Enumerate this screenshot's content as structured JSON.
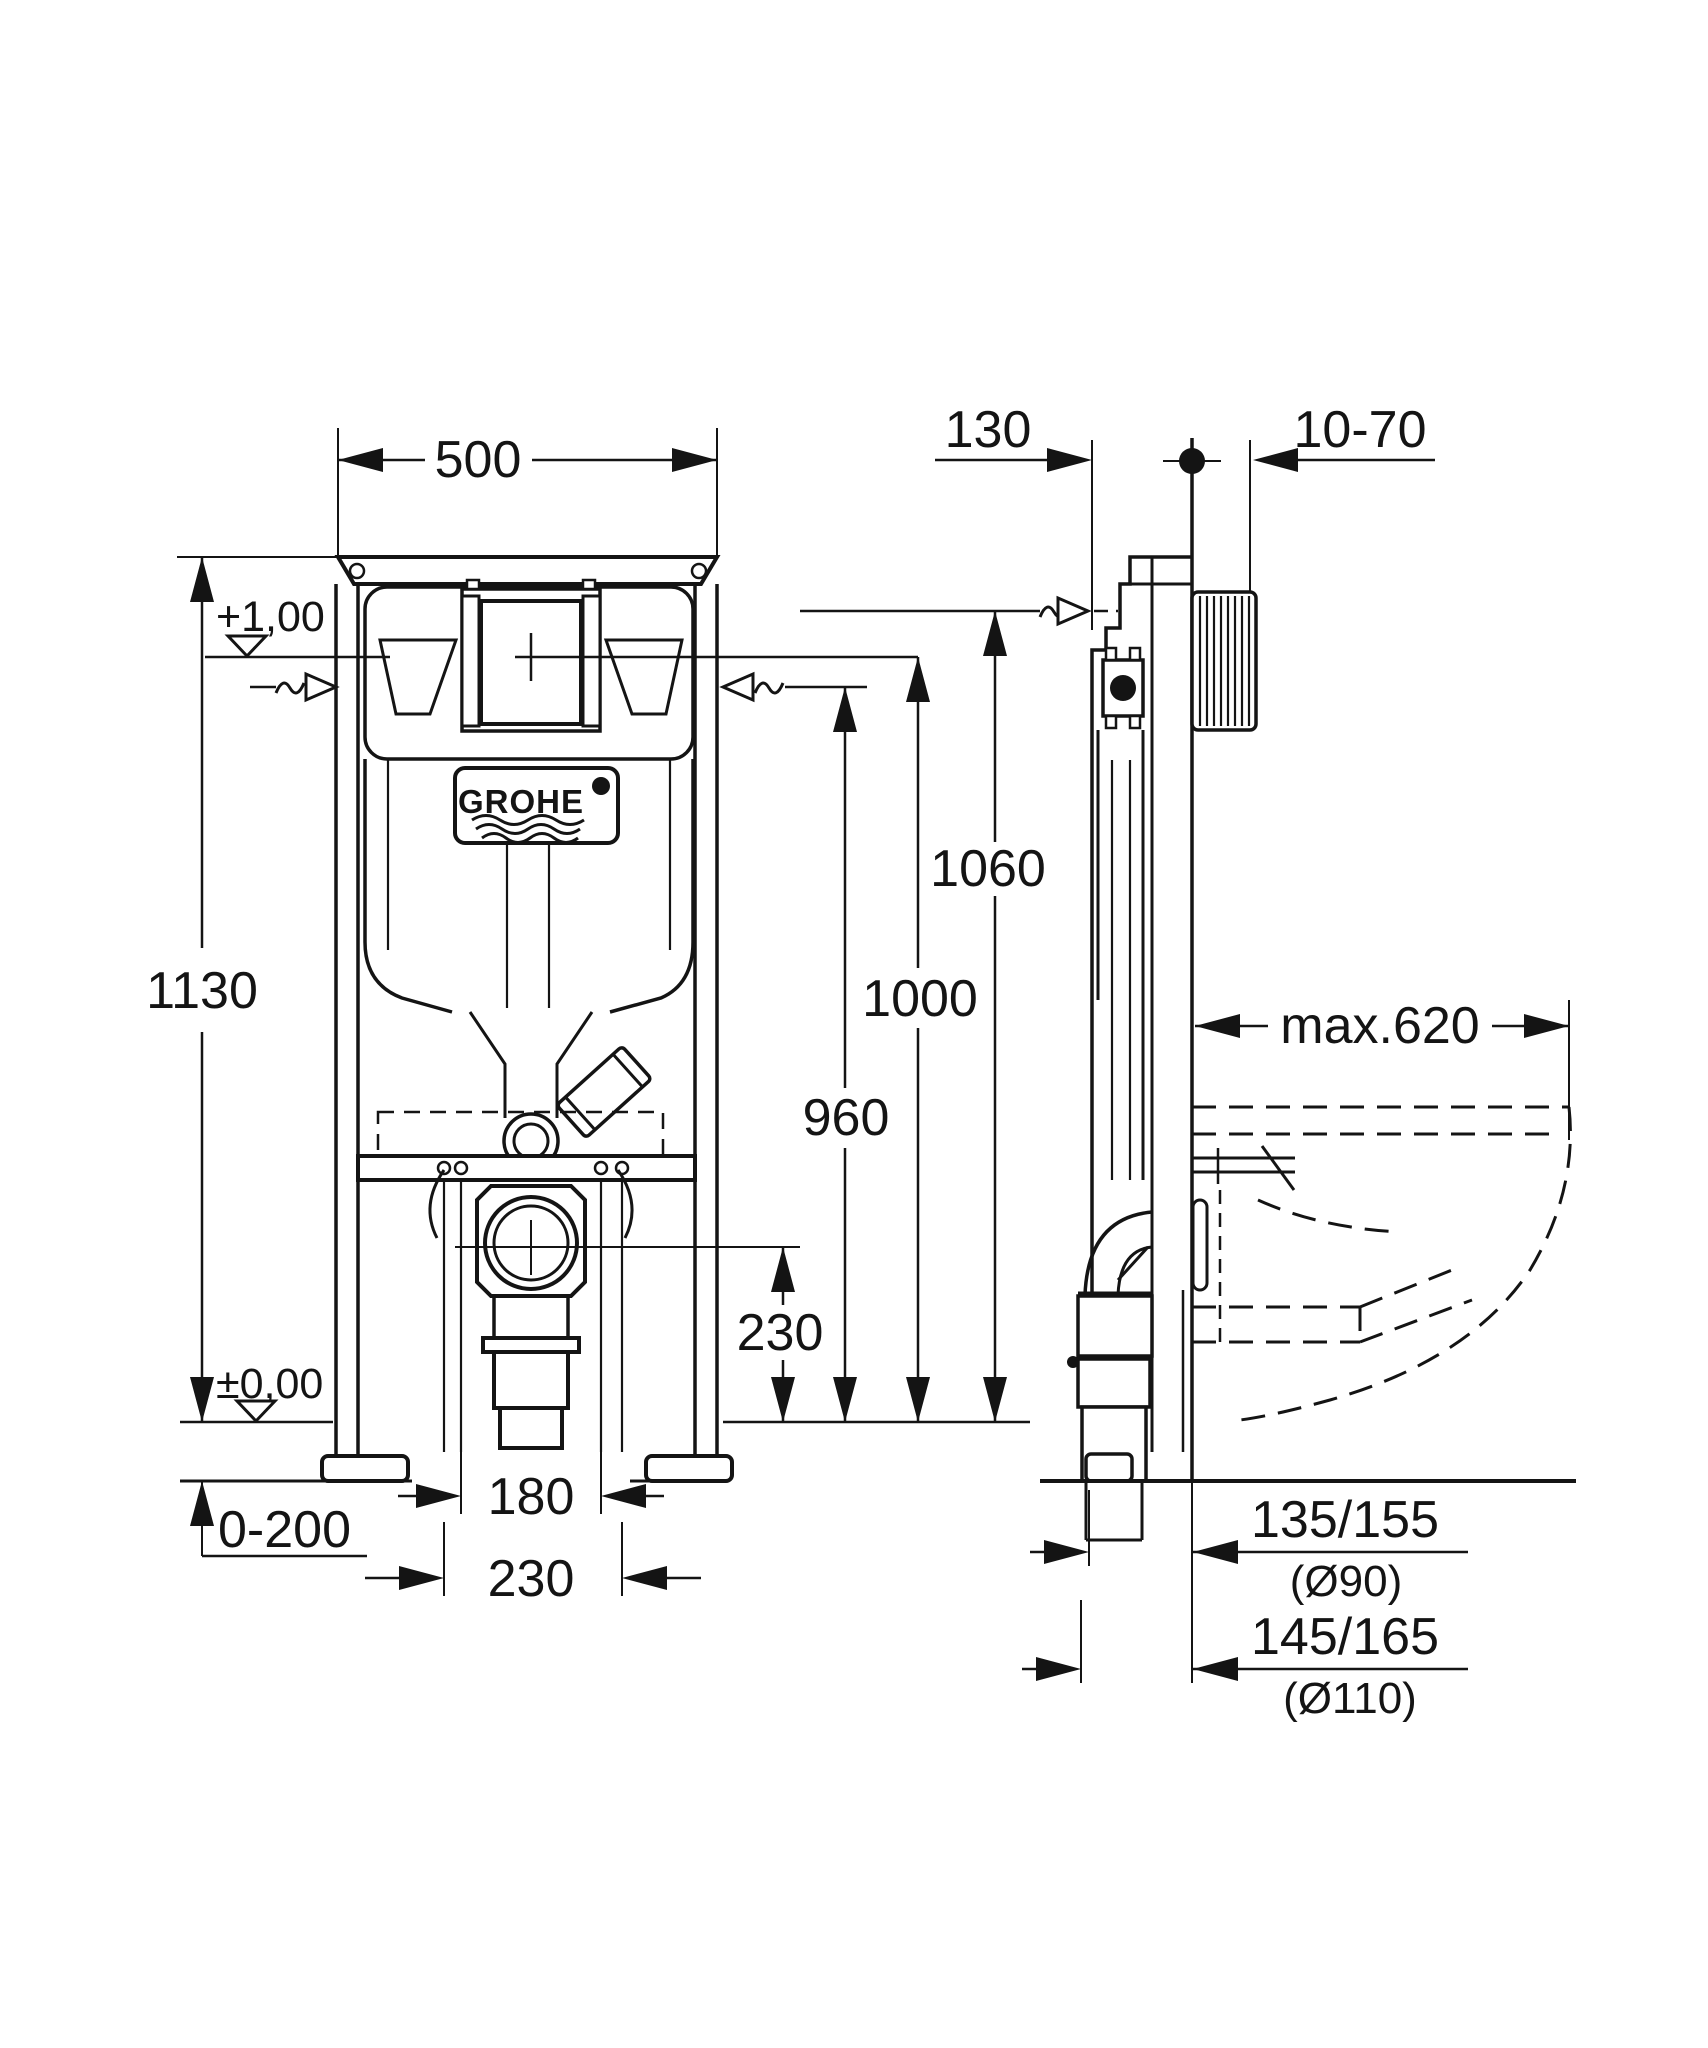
{
  "drawing": {
    "brand": "GROHE",
    "front_view": {
      "width_dim": "500",
      "height_dim": "1130",
      "upper_level_dim": "+1,00",
      "floor_level_dim": "±0,00",
      "floor_adjust_dim": "0-200",
      "bolt_spacing_inner_dim": "180",
      "bolt_spacing_outer_dim": "230",
      "drain_height_dim": "230",
      "supply_height_dim": "960",
      "actuation_height_dim": "1000",
      "top_connection_dim": "1060"
    },
    "side_view": {
      "frame_depth_dim": "130",
      "wall_finish_range_dim": "10-70",
      "bowl_depth_dim": "max.620",
      "outlet_90_dim": "135/155",
      "outlet_90_diameter": "(Ø90)",
      "outlet_110_dim": "145/165",
      "outlet_110_diameter": "(Ø110)"
    }
  }
}
